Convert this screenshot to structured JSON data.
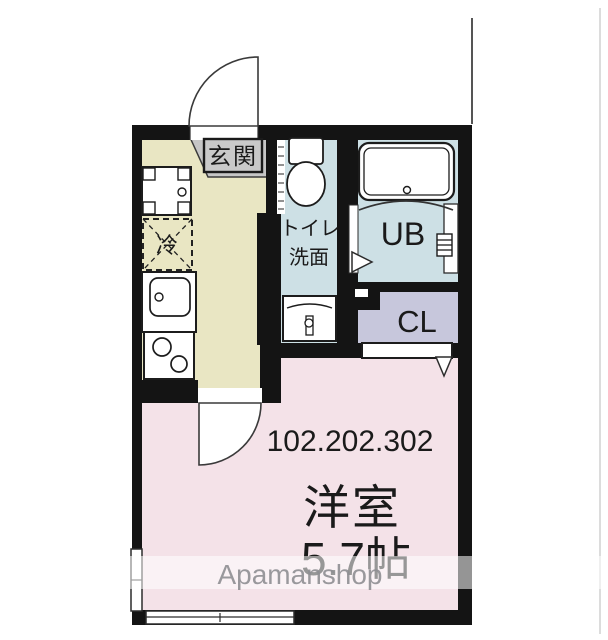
{
  "plan": {
    "entrance_label": "玄関",
    "toilet_label_1": "トイレ",
    "toilet_label_2": "洗面",
    "unit_bath_label": "UB",
    "closet_label": "CL",
    "fridge_label": "冷",
    "room_numbers": "102.202.302",
    "main_room_label": "洋室",
    "main_room_size": "5.7帖"
  },
  "watermark": "Apamanshop",
  "colors": {
    "wall": "#141414",
    "kitchen_floor": "#e9e6c3",
    "entrance_floor": "#c6c6c6",
    "entrance_label_bg": "#c9c9c9",
    "wet_area_floor": "#cde0e5",
    "closet_floor": "#c7c7dc",
    "main_room_floor": "#f4e2e8"
  }
}
